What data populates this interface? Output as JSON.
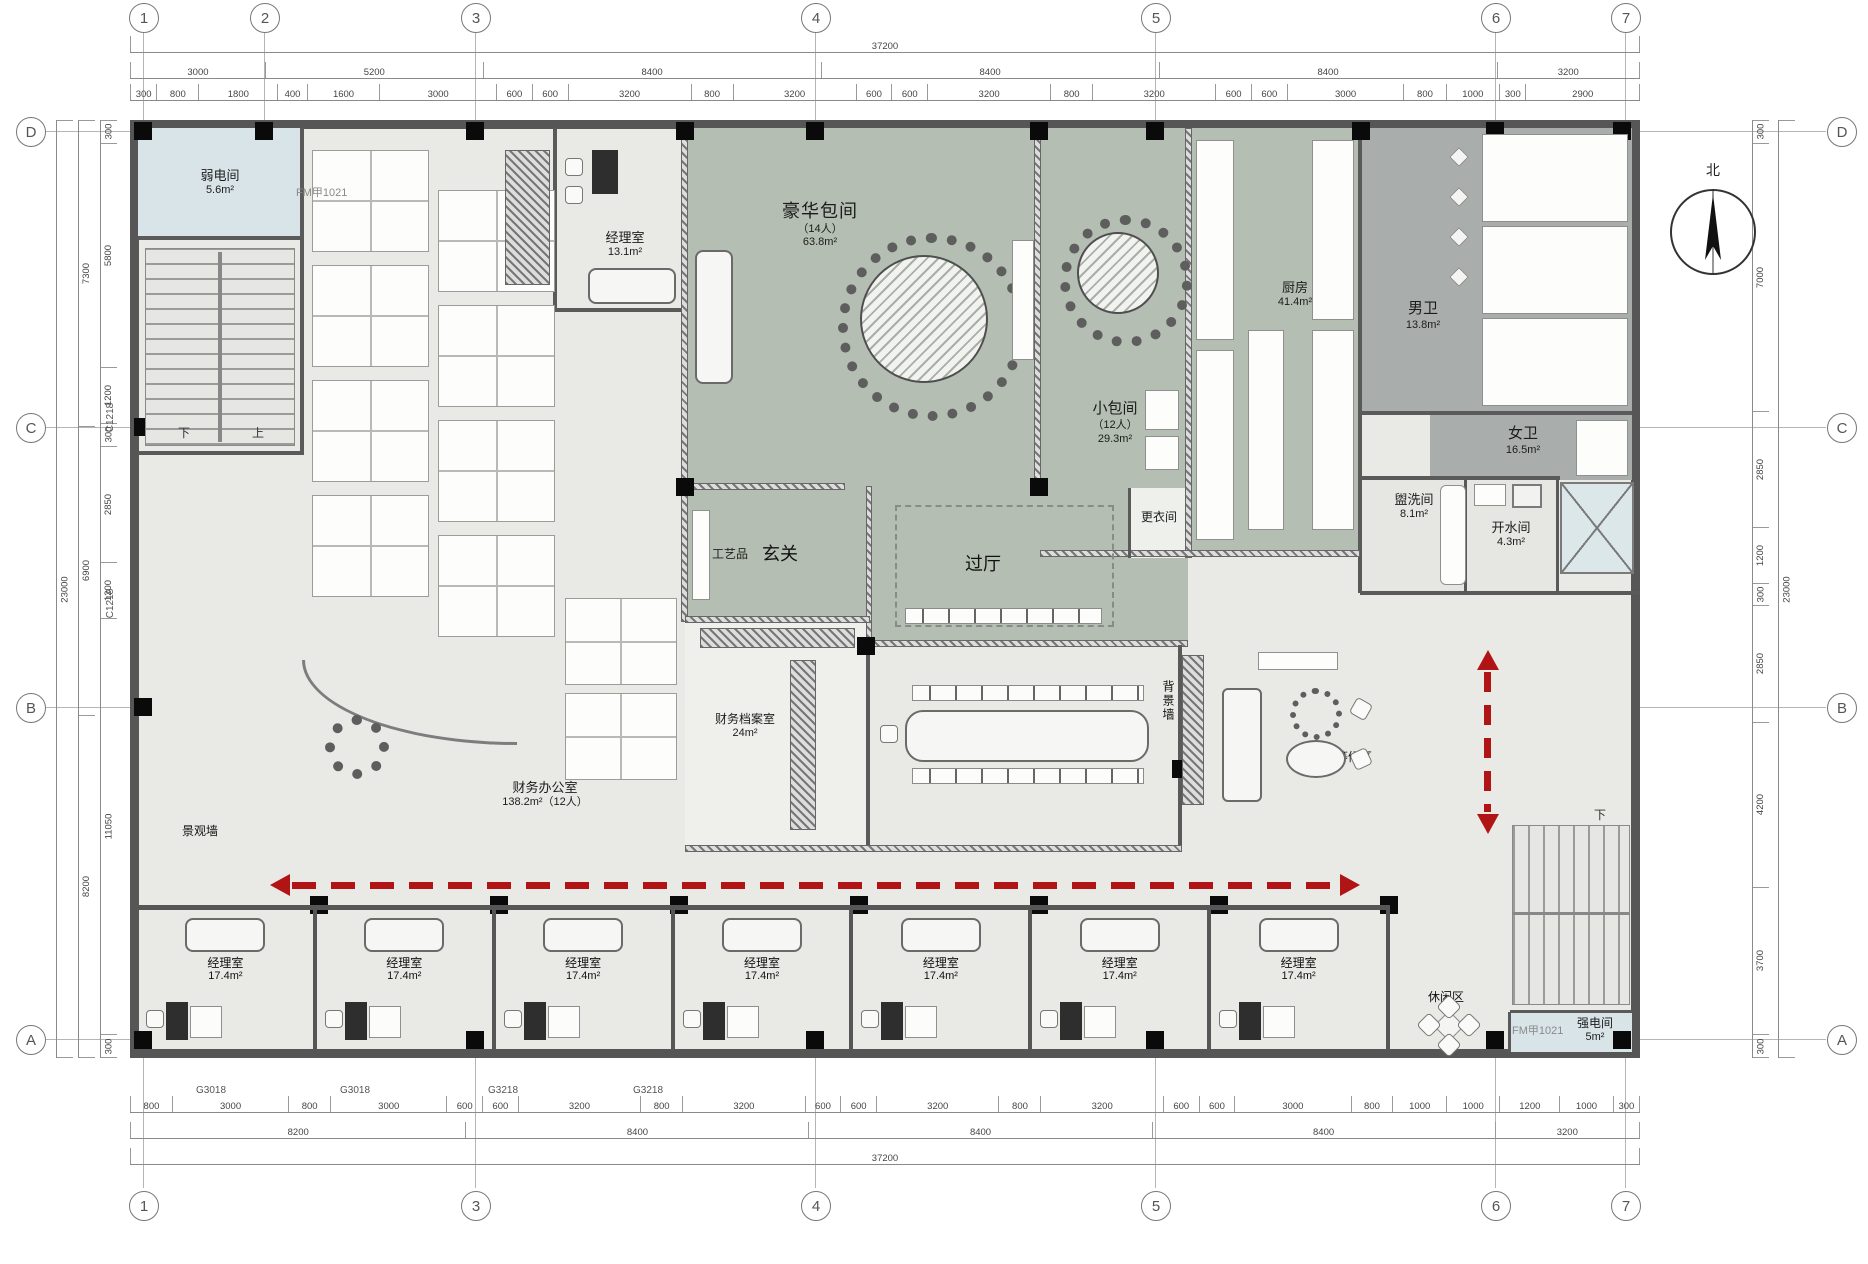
{
  "drawing": {
    "compass_label": "北",
    "stair_down_left": "下",
    "stair_up_left": "上",
    "stair_down_right": "下"
  },
  "grid": {
    "top": [
      "1",
      "2",
      "3",
      "4",
      "5",
      "6",
      "7"
    ],
    "bottom": [
      "1",
      "3",
      "4",
      "5",
      "6",
      "7"
    ],
    "left": [
      "D",
      "C",
      "B",
      "A"
    ],
    "right": [
      "D",
      "C",
      "B",
      "A"
    ]
  },
  "dims": {
    "top_total": "37200",
    "top_major": [
      "3000",
      "5200",
      "8400",
      "8400",
      "8400",
      "3200"
    ],
    "top_detail": [
      "300",
      "800",
      "1800",
      "400",
      "1600",
      "3000",
      "600",
      "600",
      "3200",
      "800",
      "3200",
      "600",
      "600",
      "3200",
      "800",
      "3200",
      "600",
      "600",
      "3000",
      "800",
      "1000",
      "300",
      "2900"
    ],
    "bottom_detail": [
      "800",
      "3000",
      "800",
      "3000",
      "600",
      "600",
      "3200",
      "800",
      "3200",
      "600",
      "600",
      "3200",
      "800",
      "3200",
      "600",
      "600",
      "3000",
      "800",
      "1000",
      "1000",
      "1200",
      "1000",
      "300"
    ],
    "bottom_major": [
      "8200",
      "8400",
      "8400",
      "8400",
      "3200"
    ],
    "bottom_total": "37200",
    "left_detail": [
      "300",
      "5800",
      "1200",
      "300",
      "2850",
      "1200",
      "11050",
      "300"
    ],
    "left_major": [
      "7300",
      "6900",
      "8200"
    ],
    "left_total": "23000",
    "right_detail": [
      "300",
      "7000",
      "2850",
      "1200",
      "300",
      "2850",
      "4200",
      "3700",
      "300"
    ],
    "right_total": "23000",
    "window_left_1": "C1218",
    "window_left_2": "C1218",
    "window_bottom_1": "G3018",
    "window_bottom_2": "G3018",
    "window_bottom_3": "G3218",
    "window_bottom_4": "G3218",
    "door_right": "M1224",
    "door_top": "FM甲1021",
    "door_bottom": "FM甲1021"
  },
  "rooms": {
    "weak_power": {
      "name": "弱电间",
      "area": "5.6m²"
    },
    "manager_top": {
      "name": "经理室",
      "area": "13.1m²"
    },
    "luxury": {
      "name": "豪华包间",
      "capacity": "（14人）",
      "area": "63.8m²"
    },
    "small_private": {
      "name": "小包间",
      "capacity": "（12人）",
      "area": "29.3m²"
    },
    "kitchen": {
      "name": "厨房",
      "area": "41.4m²"
    },
    "male_wc": {
      "name": "男卫",
      "area": "13.8m²"
    },
    "female_wc": {
      "name": "女卫",
      "area": "16.5m²"
    },
    "wash": {
      "name": "盥洗间",
      "area": "8.1m²"
    },
    "water": {
      "name": "开水间",
      "area": "4.3m²"
    },
    "changing": {
      "name": "更衣间"
    },
    "crafts": {
      "name": "工艺品"
    },
    "foyer": {
      "name": "玄关"
    },
    "hall": {
      "name": "过厅"
    },
    "archives": {
      "name": "财务档案室",
      "area": "24m²"
    },
    "meeting": {
      "name": "会议室",
      "area": "34.1m²（14人）"
    },
    "bg_wall": {
      "name": "背景墙"
    },
    "rest": {
      "name": "休息、等候区"
    },
    "landscape": {
      "name": "景观墙"
    },
    "finance": {
      "name": "财务办公室",
      "area": "138.2m²（12人）"
    },
    "leisure": {
      "name": "休闲区"
    },
    "strong_power": {
      "name": "强电间",
      "area": "5m²"
    }
  },
  "manager_rooms": [
    {
      "name": "经理室",
      "area": "17.4m²"
    },
    {
      "name": "经理室",
      "area": "17.4m²"
    },
    {
      "name": "经理室",
      "area": "17.4m²"
    },
    {
      "name": "经理室",
      "area": "17.4m²"
    },
    {
      "name": "经理室",
      "area": "17.4m²"
    },
    {
      "name": "经理室",
      "area": "17.4m²"
    },
    {
      "name": "经理室",
      "area": "17.4m²"
    }
  ],
  "colors": {
    "dining_green": "#b5beb2",
    "wc_gray": "#a9aeac",
    "power_blue": "#d9e4e8",
    "floor_gray": "#e9e9e6",
    "arrow_red": "#b11414",
    "wall_dark": "#565656"
  }
}
